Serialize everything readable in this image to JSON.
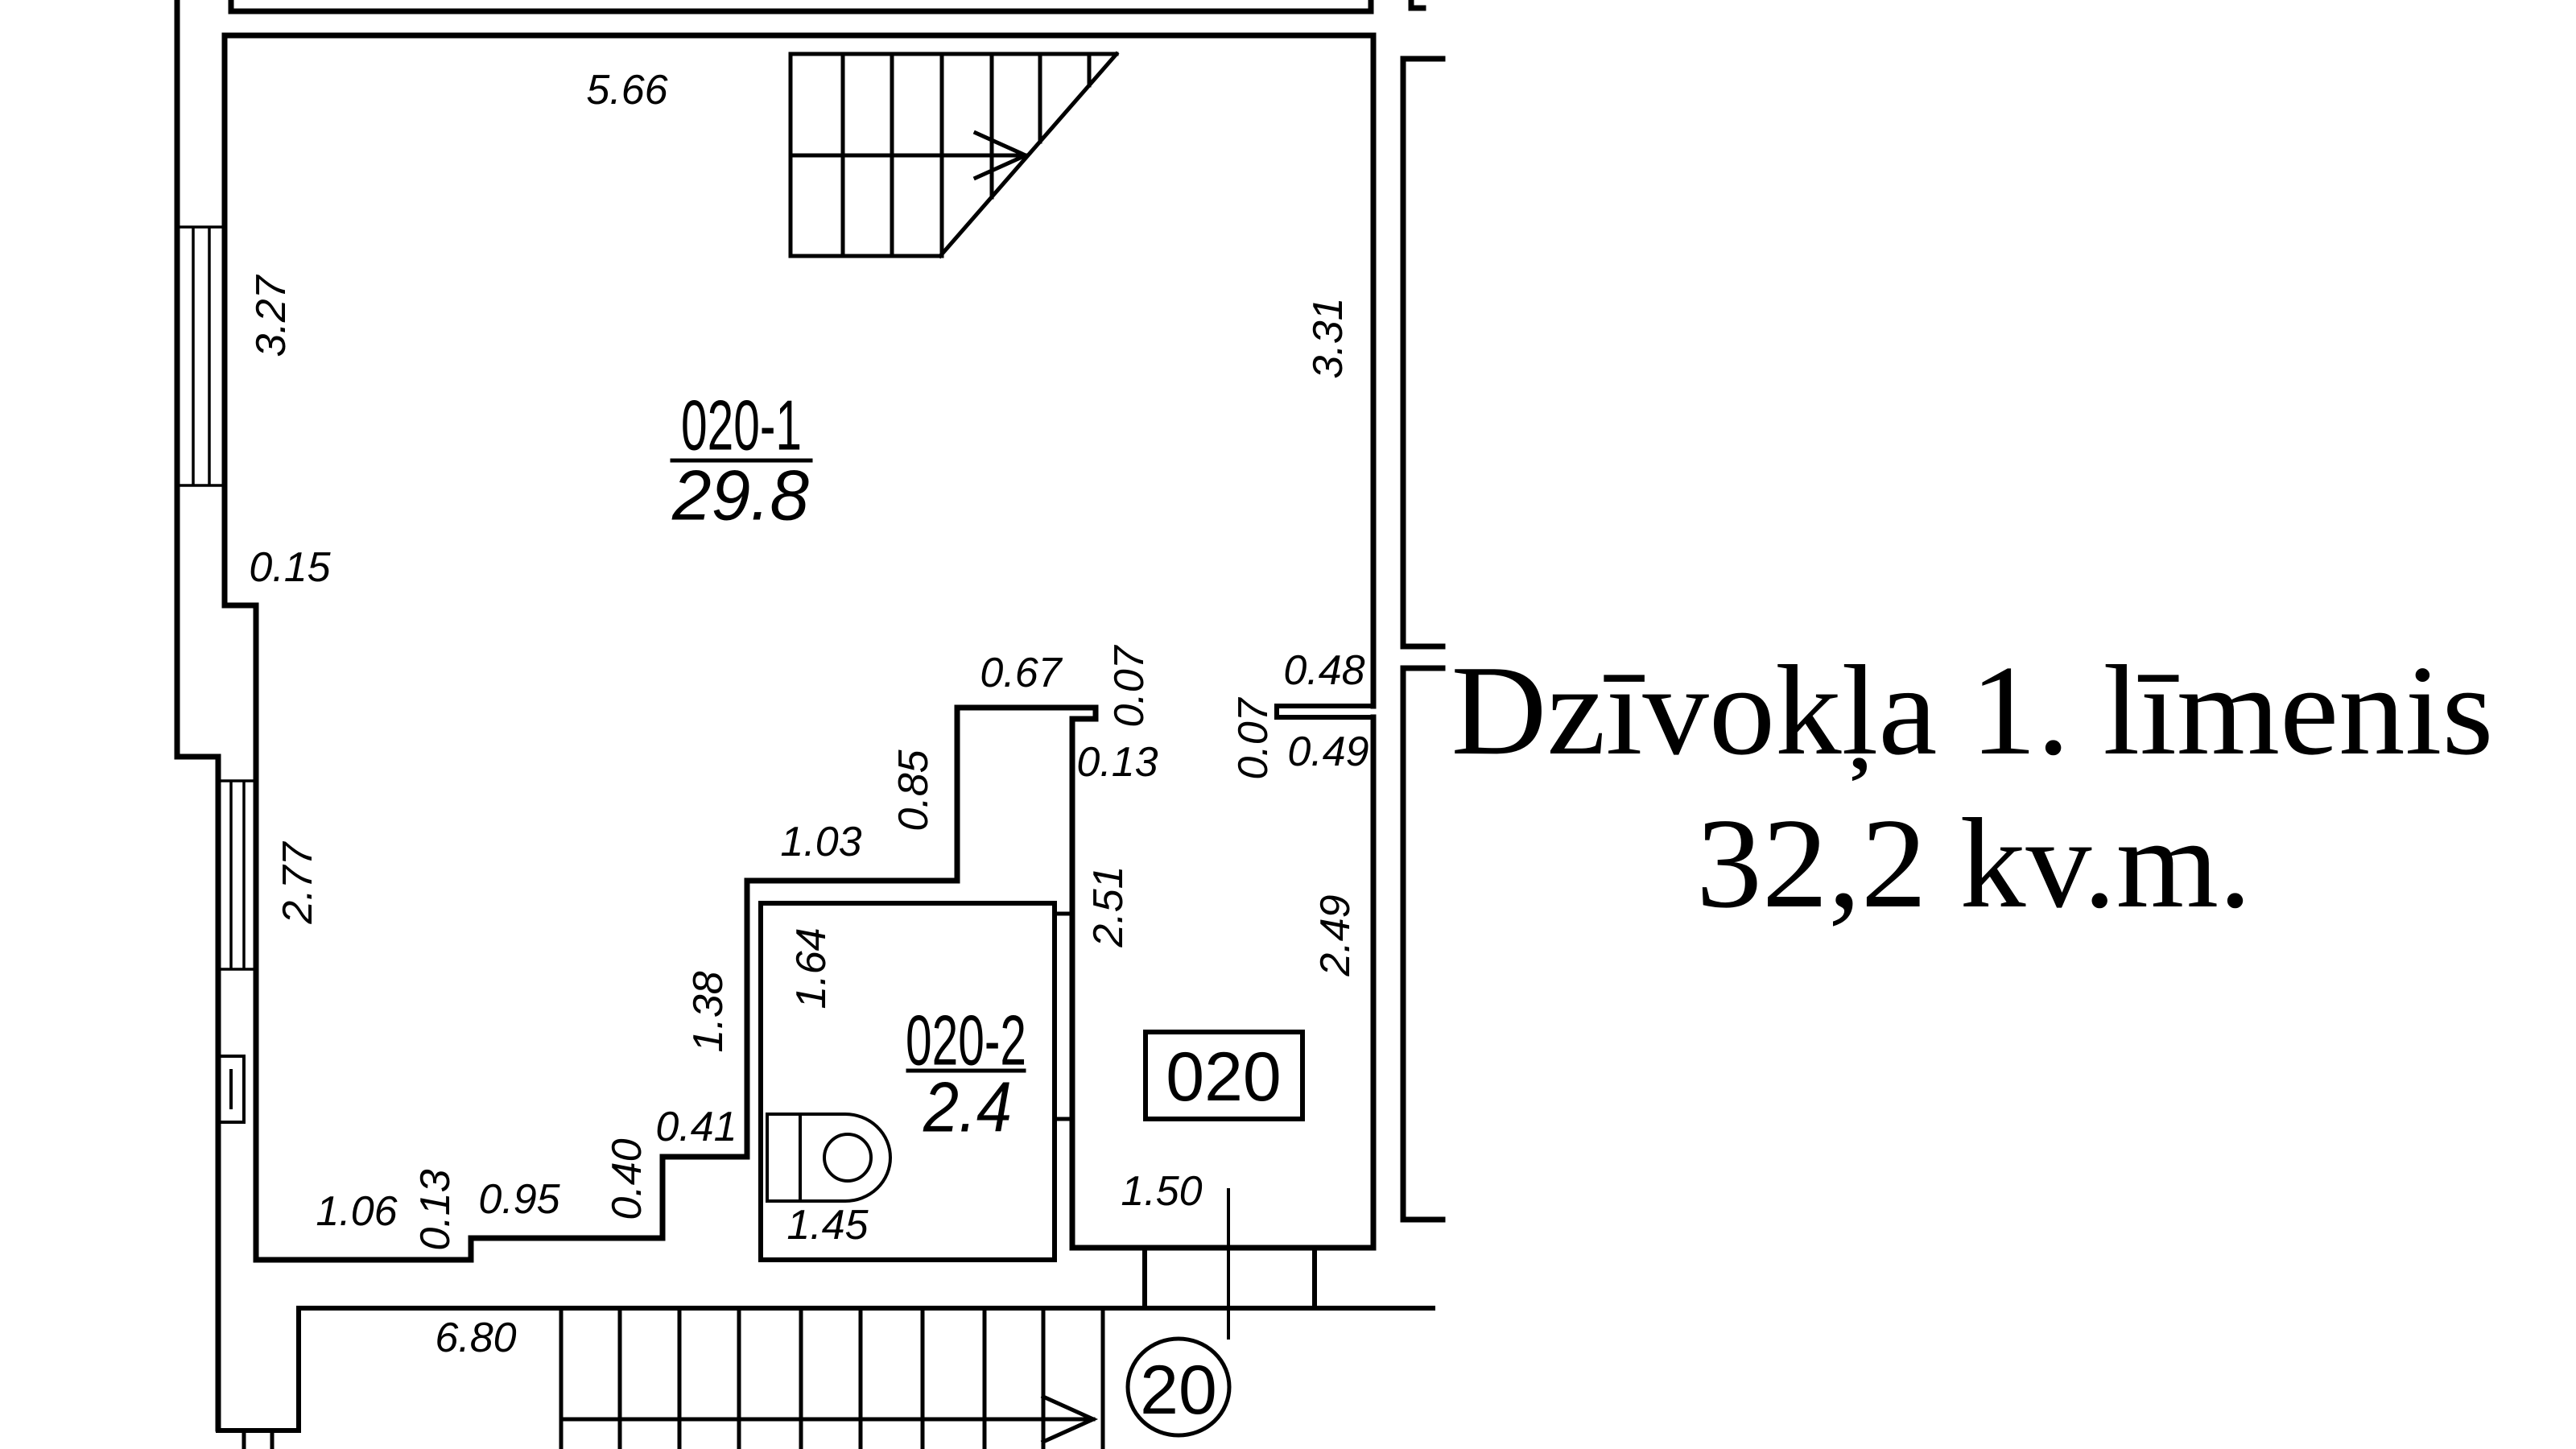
{
  "title": {
    "line1": "Dzīvokļa 1. līmenis",
    "line2": "32,2 kv.m."
  },
  "rooms": {
    "room1": {
      "id": "020-1",
      "area": "29.8"
    },
    "room2": {
      "id": "020-2",
      "area": "2.4"
    }
  },
  "apartment_number_box": "020",
  "stair_circle_number": "20",
  "dims": {
    "top_width": "5.66",
    "left_upper": "3.27",
    "left_step": "0.15",
    "left_lower": "2.77",
    "bottom_seg1": "1.06",
    "bottom_step": "0.13",
    "bottom_seg2": "0.95",
    "step_up": "0.40",
    "step_right": "0.41",
    "wc_width": "1.45",
    "wc_left_height": "1.38",
    "wc_inner_height": "1.64",
    "niche_top": "1.03",
    "niche_left": "0.85",
    "niche_width": "0.67",
    "niche_step_v": "0.07",
    "niche_step_h": "0.13",
    "right_upper": "3.31",
    "right_gap_top": "0.48",
    "right_gap_small": "0.07",
    "right_gap_bottom": "0.49",
    "corridor_height": "2.51",
    "right_lower": "2.49",
    "corridor_width": "1.50",
    "lobby_width": "6.80"
  },
  "colors": {
    "ink": "#000000",
    "background": "#ffffff"
  }
}
